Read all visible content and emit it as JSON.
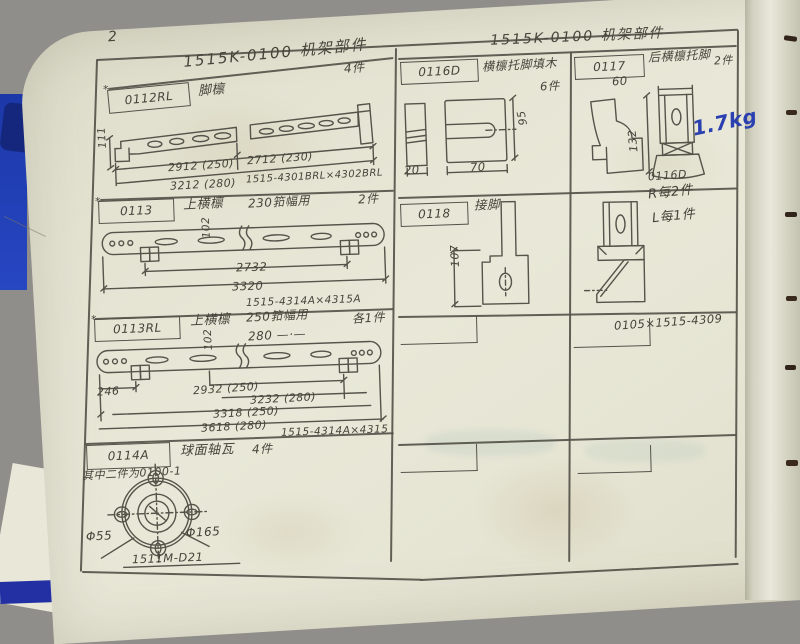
{
  "page": {
    "number": "2"
  },
  "header": {
    "title_left": "1515K-0100  机架部件",
    "title_right": "1515K-0100  机架部件"
  },
  "left_column": {
    "row1": {
      "mark": "*",
      "code": "0112RL",
      "name": "脚檩",
      "qty": "4件",
      "dim_height": "111",
      "dim_len_a": "2912 (250)",
      "dim_len_b": "2712 (230)",
      "dim_len_c": "3212 (280)",
      "ref": "1515-4301BRL×4302BRL"
    },
    "row2": {
      "mark": "*",
      "code": "0113",
      "name": "上横檩",
      "spec": "230筘幅用",
      "qty": "2件",
      "dim_height": "102",
      "dim_len_a": "2732",
      "dim_len_b": "3320",
      "ref": "1515-4314A×4315A"
    },
    "row3": {
      "mark": "*",
      "code": "0113RL",
      "name": "上横檩",
      "spec_a": "250筘幅用",
      "spec_b": "280 —·—",
      "qty": "各1件",
      "dim_height": "102",
      "dim_left": "246",
      "dim_len_a": "2932 (250)",
      "dim_len_b": "3232 (280)",
      "dim_len_c": "3318 (250)",
      "dim_len_d": "3618 (280)",
      "ref": "1515-4314A×4315"
    },
    "row4": {
      "code": "0114A",
      "name": "球面轴瓦",
      "qty": "4件",
      "note": "其中二件为0100-1",
      "dim_inner": "Φ55",
      "dim_outer": "Φ165",
      "ref": "1511M-D21"
    }
  },
  "right_column": {
    "cell_0116d": {
      "code": "0116D",
      "name": "横檩托脚填木",
      "qty": "6件",
      "dim_thickness": "20",
      "dim_width": "70",
      "dim_height": "95"
    },
    "cell_0117": {
      "code": "0117",
      "name": "后横檩托脚",
      "qty": "2件",
      "dim_width": "60",
      "dim_height": "132",
      "weight_note": "1.7kg",
      "block_label": "0116D"
    },
    "cell_0118": {
      "code": "0118",
      "name": "接脚",
      "dim_height": "107",
      "note_r": "R每2件",
      "note_l": "L每1件",
      "ref": "0105×1515-4309"
    }
  }
}
